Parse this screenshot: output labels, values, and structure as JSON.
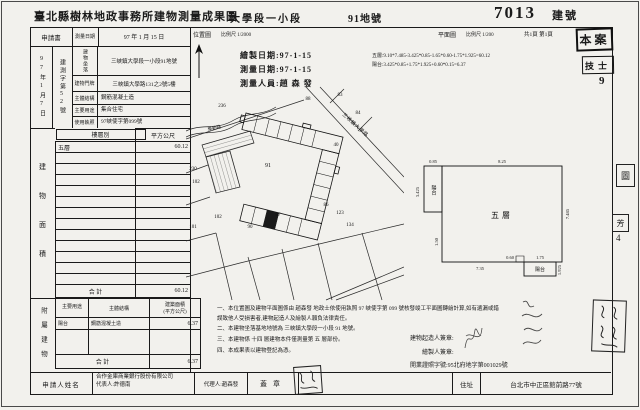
{
  "page": {
    "title": "臺北縣樹林地政事務所建物測量成果圖",
    "section": "大學段一小段",
    "lot_no": "91地號",
    "building_no": "7013",
    "building_no_label": "建號"
  },
  "form_header": {
    "application": "申請書",
    "survey_date_label": "測量日期",
    "survey_date": "97 年 1 月 15 日",
    "location_map_label": "位置圖",
    "location_map_scale": "比例尺 1/2000",
    "floor_plan_label": "平面圖",
    "floor_plan_scale": "比例尺 1/200",
    "page_count": "共1頁 第1頁",
    "approval_stamp": "本案"
  },
  "intake": {
    "date_vertical": "97年1月7日",
    "no_vertical": "建測字第52號"
  },
  "building_info": {
    "rows": [
      {
        "label": "建物坐落",
        "value": "三峽鎮大學段一小段91地號"
      },
      {
        "label": "建物門牌",
        "value": "三峽鎮大學路131之2號5樓"
      },
      {
        "label": "主體結構",
        "value": "鋼筋混凝土造"
      },
      {
        "label": "主要用途",
        "value": "集合住宅"
      },
      {
        "label": "使用執照",
        "value": "97峽使字第099號"
      }
    ]
  },
  "area_table": {
    "side_label": "建物面積",
    "floor_col": "樓層別",
    "area_col": "平方公尺",
    "floor": "五層",
    "floor_area": "60.12",
    "total_label": "合  計",
    "total": "60.12"
  },
  "annex_table": {
    "side_label": "附屬建物",
    "use_col": "主要用途",
    "structure_col": "主體結構",
    "area_col1": "建築面積",
    "area_col2": "(平方公尺)",
    "use": "陽台",
    "structure": "鋼筋混凝土造",
    "area": "6.37",
    "total_label": "合  計",
    "total": "6.37"
  },
  "drawing": {
    "draw_date": "繪製日期:97-1-15",
    "survey_date": "測量日期:97-1-15",
    "surveyor": "測量人員:趙 森 發",
    "calc_floor": "五層:9.10*7.485-3.425*0.85-1.65*0.60-1.75*1.925=60.12",
    "calc_balcony": "陽台:3.425*0.85+1.75*1.925+0.60*0.15=6.37",
    "technician_stamp": "技士",
    "technician_no": "9"
  },
  "siteplan": {
    "road_main": "三峽鎮大學路",
    "road_side": "學勤路",
    "lots": [
      "236",
      "230",
      "102",
      "101",
      "91",
      "88",
      "83",
      "84",
      "40",
      "86",
      "87",
      "90",
      "123",
      "134",
      "102"
    ]
  },
  "floorplan": {
    "label": "五層",
    "balcony1": "陽台",
    "balcony2": "陽台",
    "dims": [
      "0.85",
      "8.25",
      "3.425",
      "7.485",
      "1.75",
      "1.925",
      "0.60",
      "7.35",
      "1.50"
    ]
  },
  "notes": {
    "line1": "一、本位置圖及建物平面圖係由 趙森發 地政士依使用執照 97 峽使字第 099 號核發竣工平面圖轉繪計算,如有遺漏或錯誤致他人受損害者,建物起造人及繪製人願負法律責任。",
    "line2": "二、本建物坐落基地地號為 三峽鎮大學段一小段 91 地號。",
    "line3": "三、本建物係 十四 層建物本件僅測量第 五 層部份。",
    "line4": "四、本成果表以建物登記為憑。",
    "builder_sign": "建物起造人簽章:",
    "drafter_sign": "繪製人簽章:",
    "license": "開業證照字號:95北府地字第001029號"
  },
  "edge_stamps": {
    "s1": "圖",
    "s2": "芳",
    "s2_no": "4"
  },
  "footer": {
    "applicant_label": "申請人姓名",
    "company": "合作金庫商業銀行股份有限公司",
    "representative": "代表人:許德南",
    "agent": "代理人:趙森發",
    "seal_label": "蓋章",
    "address_label": "住址",
    "address": "台北市中正區館前路77號"
  }
}
